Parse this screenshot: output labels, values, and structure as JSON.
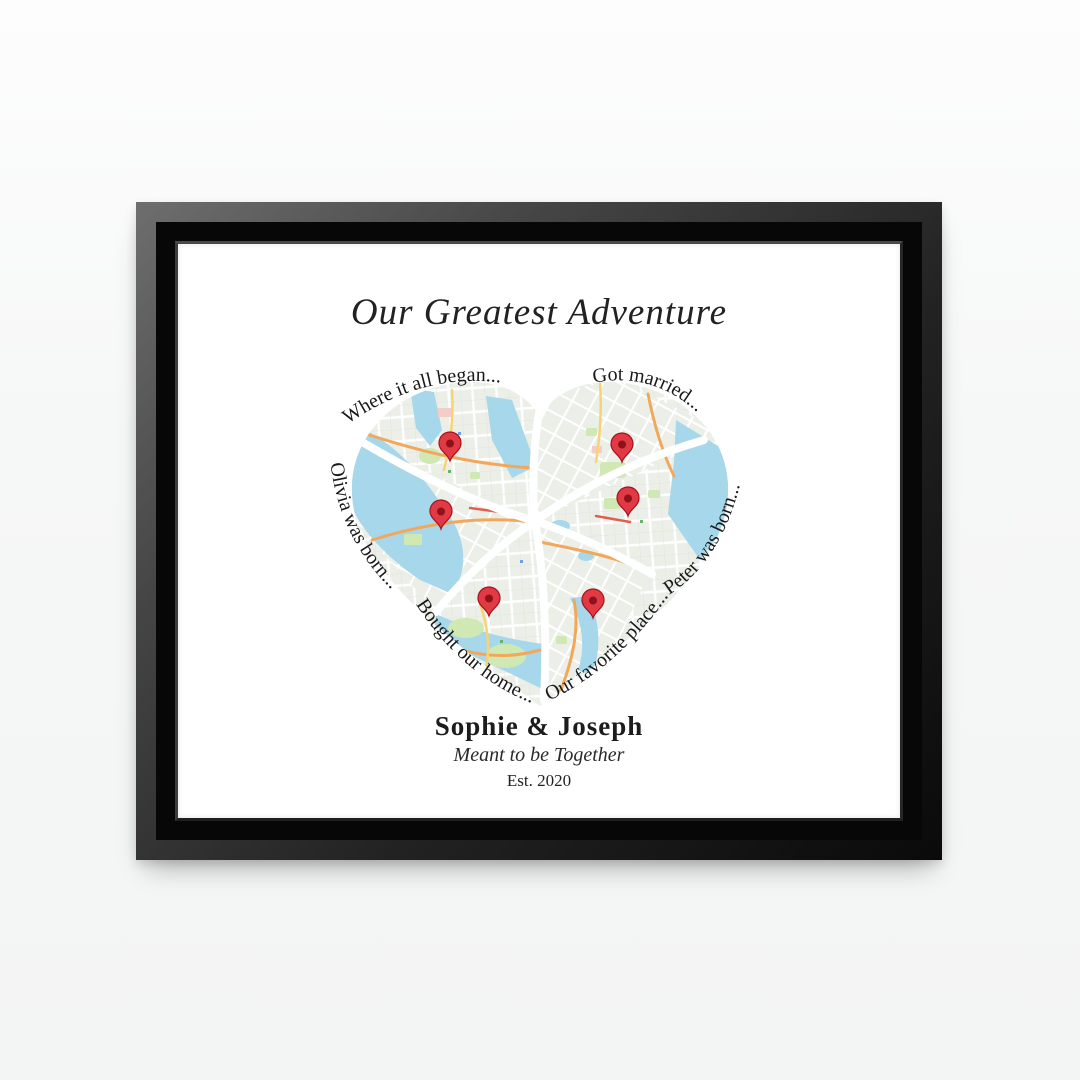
{
  "artwork": {
    "title": "Our Greatest Adventure",
    "labels": {
      "top_left": "Where it all began...",
      "top_right": "Got married...",
      "left": "Olivia was born...",
      "right": "Peter was born...",
      "bottom_left": "Bought our home...",
      "bottom_right": "Our favorite place..."
    },
    "couple_names": "Sophie & Joseph",
    "tagline": "Meant to be Together",
    "established": "Est. 2020"
  },
  "icons": {
    "map_pin": "map-pin-icon",
    "pin_count": 6
  },
  "colors": {
    "frame_black": "#141414",
    "canvas_white": "#ffffff",
    "pin_red": "#e23a44",
    "water_blue": "#a7d7ea",
    "park_green": "#cfe8b4",
    "road_orange": "#f2a85c",
    "road_yellow": "#f6d374",
    "map_base": "#ecefe8",
    "text_dark": "#1d1d1d"
  }
}
